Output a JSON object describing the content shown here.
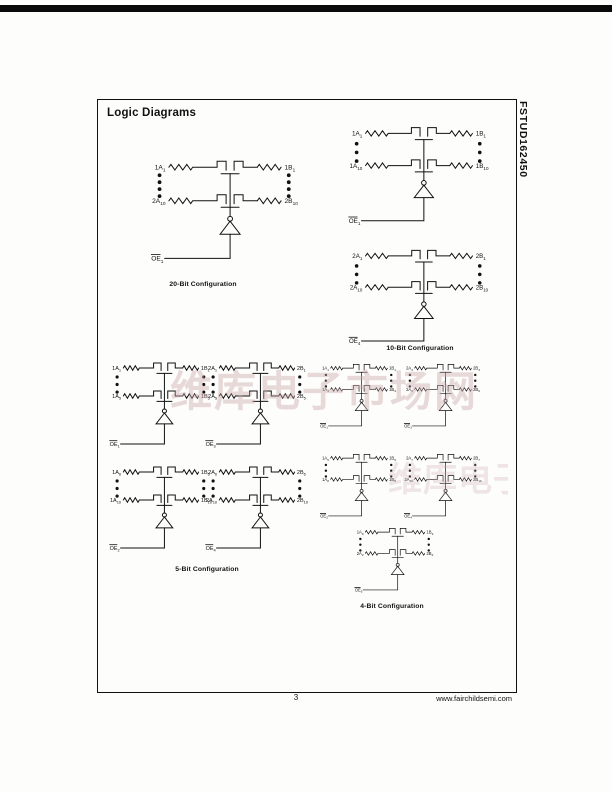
{
  "page": {
    "title": "Logic Diagrams",
    "part_number": "FSTUD162450",
    "page_number": "3",
    "website": "www.fairchildsemi.com",
    "watermark": "维库电子市场网"
  },
  "sections": {
    "cfg20": {
      "caption": "20-Bit Configuration",
      "cells": [
        {
          "tl": "1A_1",
          "tr": "1B_1",
          "bl": "2A_10",
          "br": "2B_10",
          "oe": "~OE_1",
          "dots": 4
        }
      ]
    },
    "cfg10": {
      "caption": "10-Bit Configuration",
      "cells": [
        {
          "tl": "1A_1",
          "tr": "1B_1",
          "bl": "1A_10",
          "br": "1B_10",
          "oe": "~OE_1",
          "dots": 3
        },
        {
          "tl": "2A_1",
          "tr": "2B_1",
          "bl": "2A_10",
          "br": "2B_10",
          "oe": "~OE_4",
          "dots": 3
        }
      ]
    },
    "cfg5": {
      "caption": "5-Bit Configuration",
      "cells": [
        {
          "tl": "1A_1",
          "tr": "1B_1",
          "bl": "1A_5",
          "br": "1B_5",
          "oe": "~OE_1",
          "dots": 3
        },
        {
          "tl": "2A_1",
          "tr": "2B_1",
          "bl": "2A_5",
          "br": "2B_5",
          "oe": "~OE_3",
          "dots": 3
        },
        {
          "tl": "1A_6",
          "tr": "1B_6",
          "bl": "1A_10",
          "br": "1B_10",
          "oe": "~OE_2",
          "dots": 3
        },
        {
          "tl": "2A_6",
          "tr": "2B_6",
          "bl": "2A_10",
          "br": "2B_10",
          "oe": "~OE_4",
          "dots": 3
        }
      ]
    },
    "cfg4": {
      "caption": "4-Bit Configuration",
      "cells": [
        {
          "tl": "1A_1",
          "tr": "1B_1",
          "bl": "1A_4",
          "br": "1B_4",
          "oe": "~OE_1",
          "dots": 3
        },
        {
          "tl": "2A_3",
          "tr": "2B_3",
          "bl": "2A_6",
          "br": "2B_6",
          "oe": "~OE_3",
          "dots": 3
        },
        {
          "tl": "1A_5",
          "tr": "1B_5",
          "bl": "1A_8",
          "br": "1B_8",
          "oe": "~OE_2",
          "dots": 3
        },
        {
          "tl": "2A_7",
          "tr": "2B_7",
          "bl": "2A_10",
          "br": "2B_10",
          "oe": "~OE_4",
          "dots": 3
        },
        {
          "tl": "1A_9",
          "tr": "1B_9",
          "bl": "2A_2",
          "br": "2B_2",
          "oe": "~OE_5",
          "dots": 3
        }
      ]
    }
  }
}
